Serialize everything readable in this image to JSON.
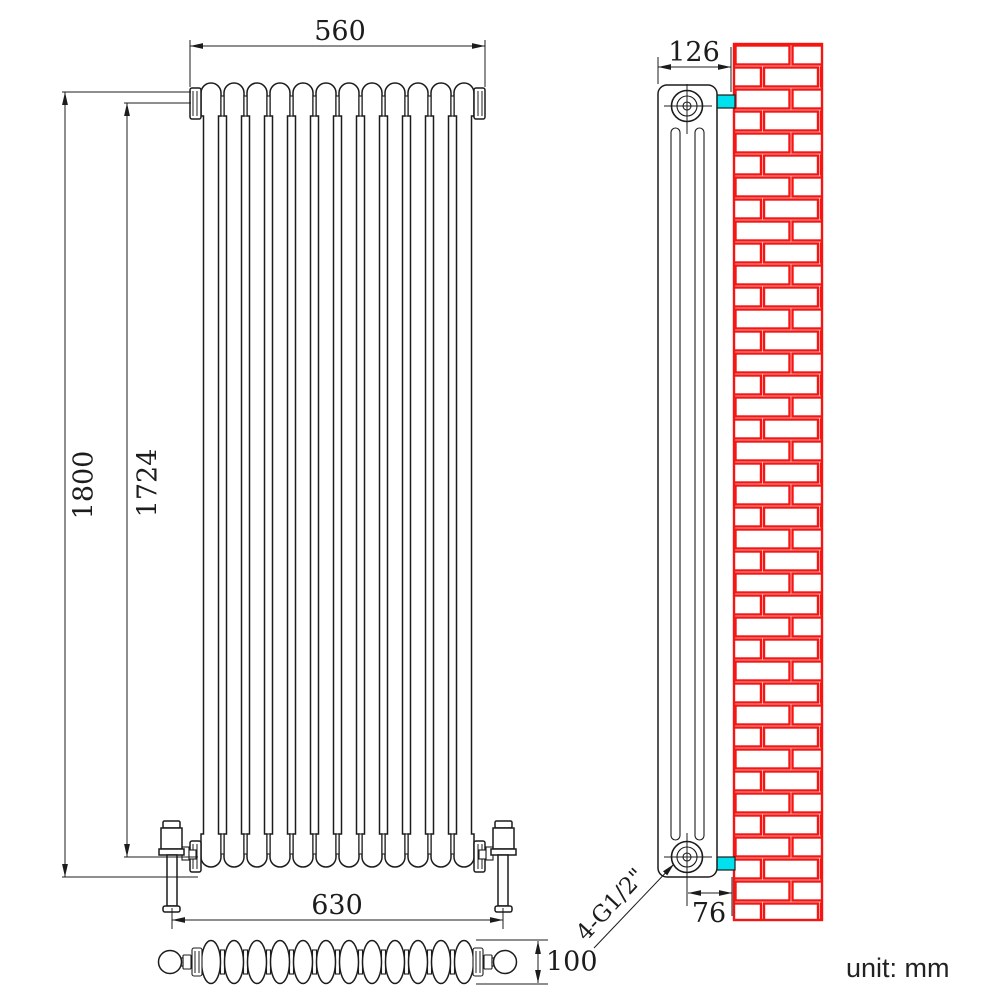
{
  "meta": {
    "unit_label": "unit: mm"
  },
  "colors": {
    "line": "#1c1c1c",
    "brick": "#f51613",
    "bracket": "#00e1ef"
  },
  "front_view": {
    "column_count": 12,
    "dims": {
      "width_top": "560",
      "height_overall": "1800",
      "height_centres": "1724",
      "valve_centres": "630"
    }
  },
  "side_view": {
    "dims": {
      "depth_overall": "126",
      "wall_to_pipe_centre": "76"
    },
    "connection_label": "4-G1/2\""
  },
  "plan_view": {
    "column_count": 12,
    "dims": {
      "depth": "100"
    }
  }
}
